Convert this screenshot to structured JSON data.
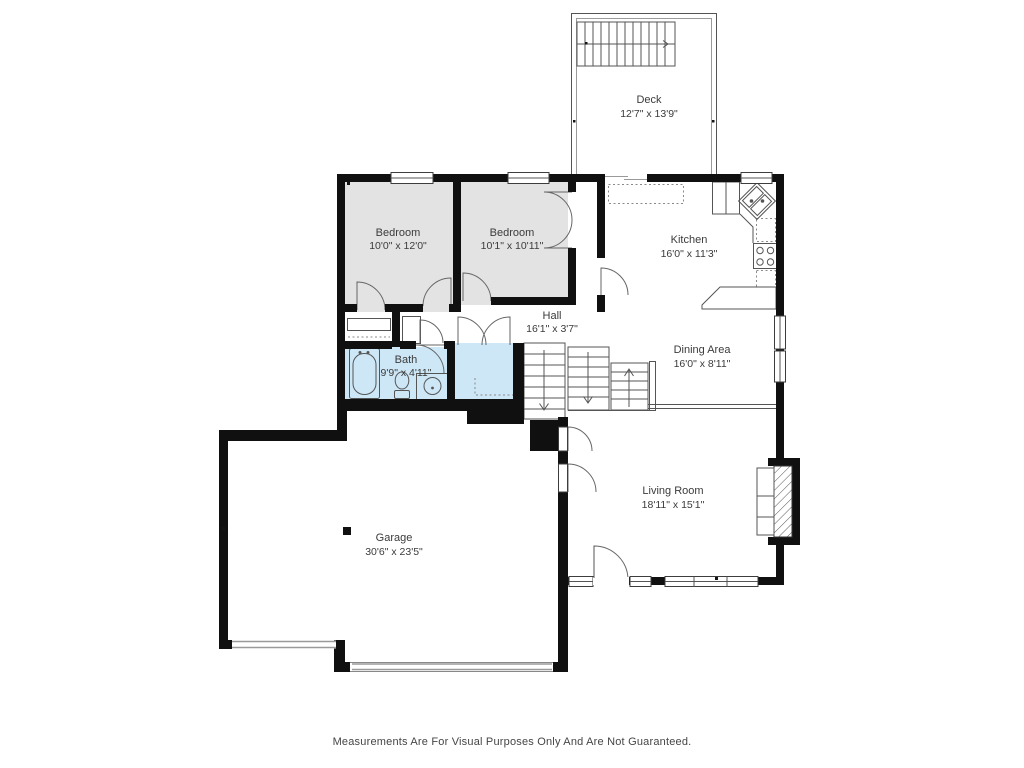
{
  "colors": {
    "wall": "#101010",
    "roomGray": "#e3e3e3",
    "roomBlue": "#cde7f7",
    "line": "#555555",
    "label": "#3b3b3b"
  },
  "rooms": {
    "deck": {
      "name": "Deck",
      "dims": "12'7\" x 13'9\""
    },
    "bedroom1": {
      "name": "Bedroom",
      "dims": "10'0\" x 12'0\""
    },
    "bedroom2": {
      "name": "Bedroom",
      "dims": "10'1\" x 10'11\""
    },
    "kitchen": {
      "name": "Kitchen",
      "dims": "16'0\" x 11'3\""
    },
    "hall": {
      "name": "Hall",
      "dims": "16'1\" x 3'7\""
    },
    "bath": {
      "name": "Bath",
      "dims": "9'9\" x 4'11\""
    },
    "dining": {
      "name": "Dining Area",
      "dims": "16'0\" x 8'11\""
    },
    "living": {
      "name": "Living Room",
      "dims": "18'11\" x 15'1\""
    },
    "garage": {
      "name": "Garage",
      "dims": "30'6\" x 23'5\""
    }
  },
  "footer": {
    "disclaimer": "Measurements Are For Visual Purposes Only And Are Not Guaranteed."
  }
}
